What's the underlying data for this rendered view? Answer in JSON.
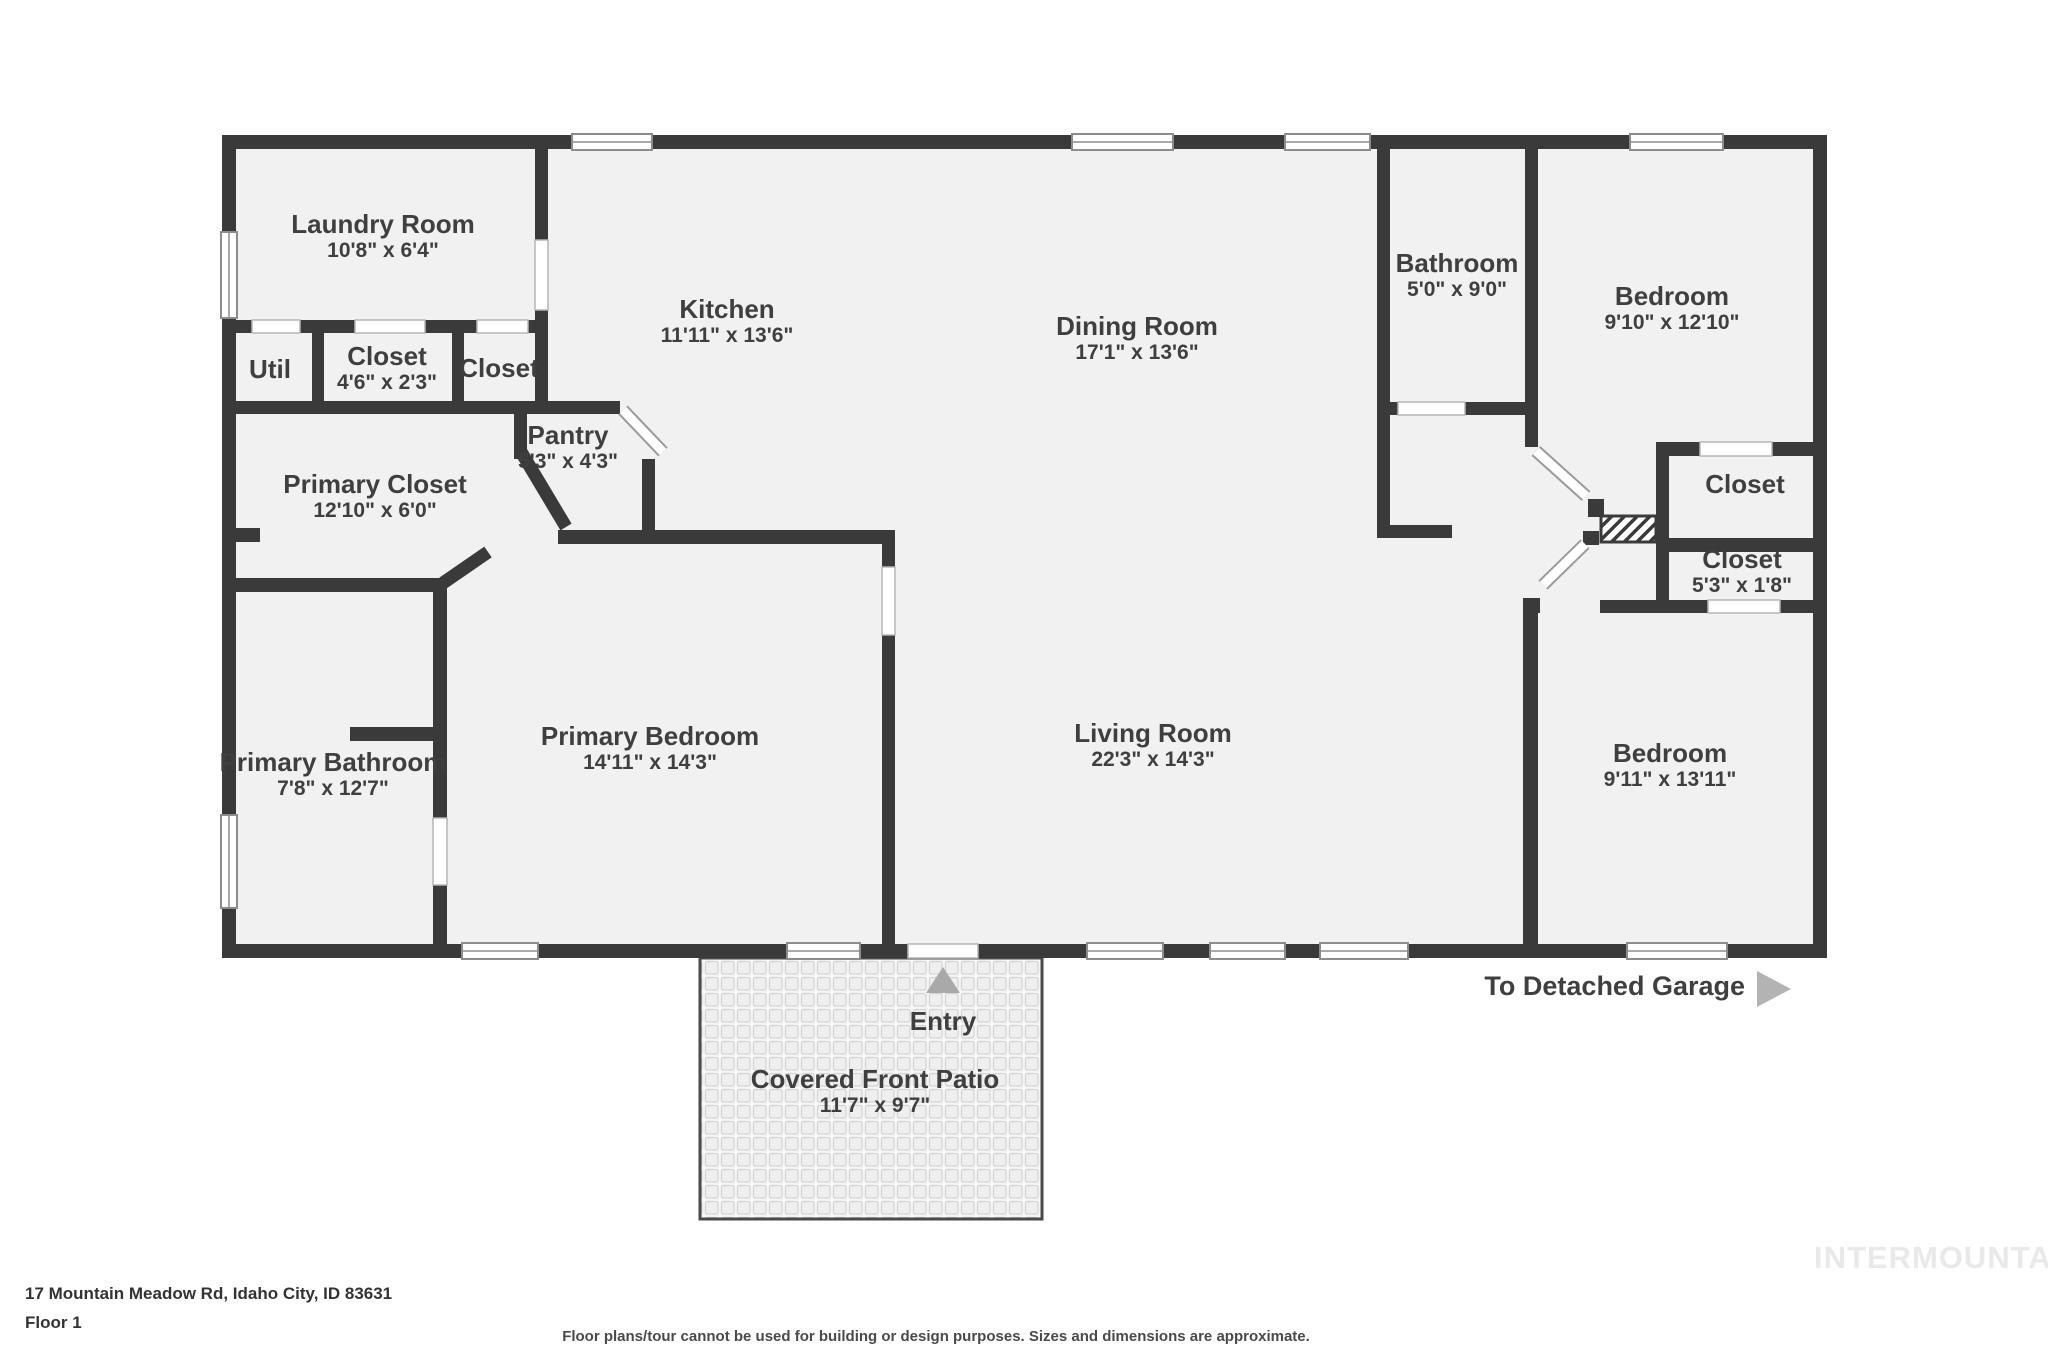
{
  "floorplan": {
    "rooms": [
      {
        "id": "laundry",
        "name": "Laundry Room",
        "dims": "10'8\" x 6'4\""
      },
      {
        "id": "util",
        "name": "Util",
        "dims": ""
      },
      {
        "id": "closet-a",
        "name": "Closet",
        "dims": "4'6\" x 2'3\""
      },
      {
        "id": "closet-b",
        "name": "Closet",
        "dims": ""
      },
      {
        "id": "pantry",
        "name": "Pantry",
        "dims": "5'3\" x 4'3\""
      },
      {
        "id": "kitchen",
        "name": "Kitchen",
        "dims": "11'11\" x 13'6\""
      },
      {
        "id": "dining",
        "name": "Dining Room",
        "dims": "17'1\" x 13'6\""
      },
      {
        "id": "bathroom",
        "name": "Bathroom",
        "dims": "5'0\" x 9'0\""
      },
      {
        "id": "bedroom-1",
        "name": "Bedroom",
        "dims": "9'10\" x 12'10\""
      },
      {
        "id": "closet-c",
        "name": "Closet",
        "dims": ""
      },
      {
        "id": "closet-d",
        "name": "Closet",
        "dims": "5'3\" x 1'8\""
      },
      {
        "id": "primary-closet",
        "name": "Primary Closet",
        "dims": "12'10\" x 6'0\""
      },
      {
        "id": "primary-bathroom",
        "name": "Primary Bathroom",
        "dims": "7'8\" x 12'7\""
      },
      {
        "id": "primary-bedroom",
        "name": "Primary Bedroom",
        "dims": "14'11\" x 14'3\""
      },
      {
        "id": "living",
        "name": "Living Room",
        "dims": "22'3\" x 14'3\""
      },
      {
        "id": "bedroom-2",
        "name": "Bedroom",
        "dims": "9'11\" x 13'11\""
      },
      {
        "id": "patio",
        "name": "Covered Front Patio",
        "dims": "11'7\" x 9'7\""
      }
    ],
    "annotations": {
      "entry": "Entry",
      "to_garage": "To Detached Garage"
    },
    "colors": {
      "wall": "#3a3a3a",
      "floor": "#f1f1f1",
      "label": "#3f3f3f",
      "arrow": "#a9a9a9",
      "watermark": "#e9e9e9"
    }
  },
  "footer": {
    "address": "17 Mountain Meadow Rd, Idaho City, ID 83631",
    "floor": "Floor 1",
    "disclaimer": "Floor plans/tour cannot be used for building or design purposes. Sizes and dimensions are approximate.",
    "watermark": "INTERMOUNTAIN"
  }
}
